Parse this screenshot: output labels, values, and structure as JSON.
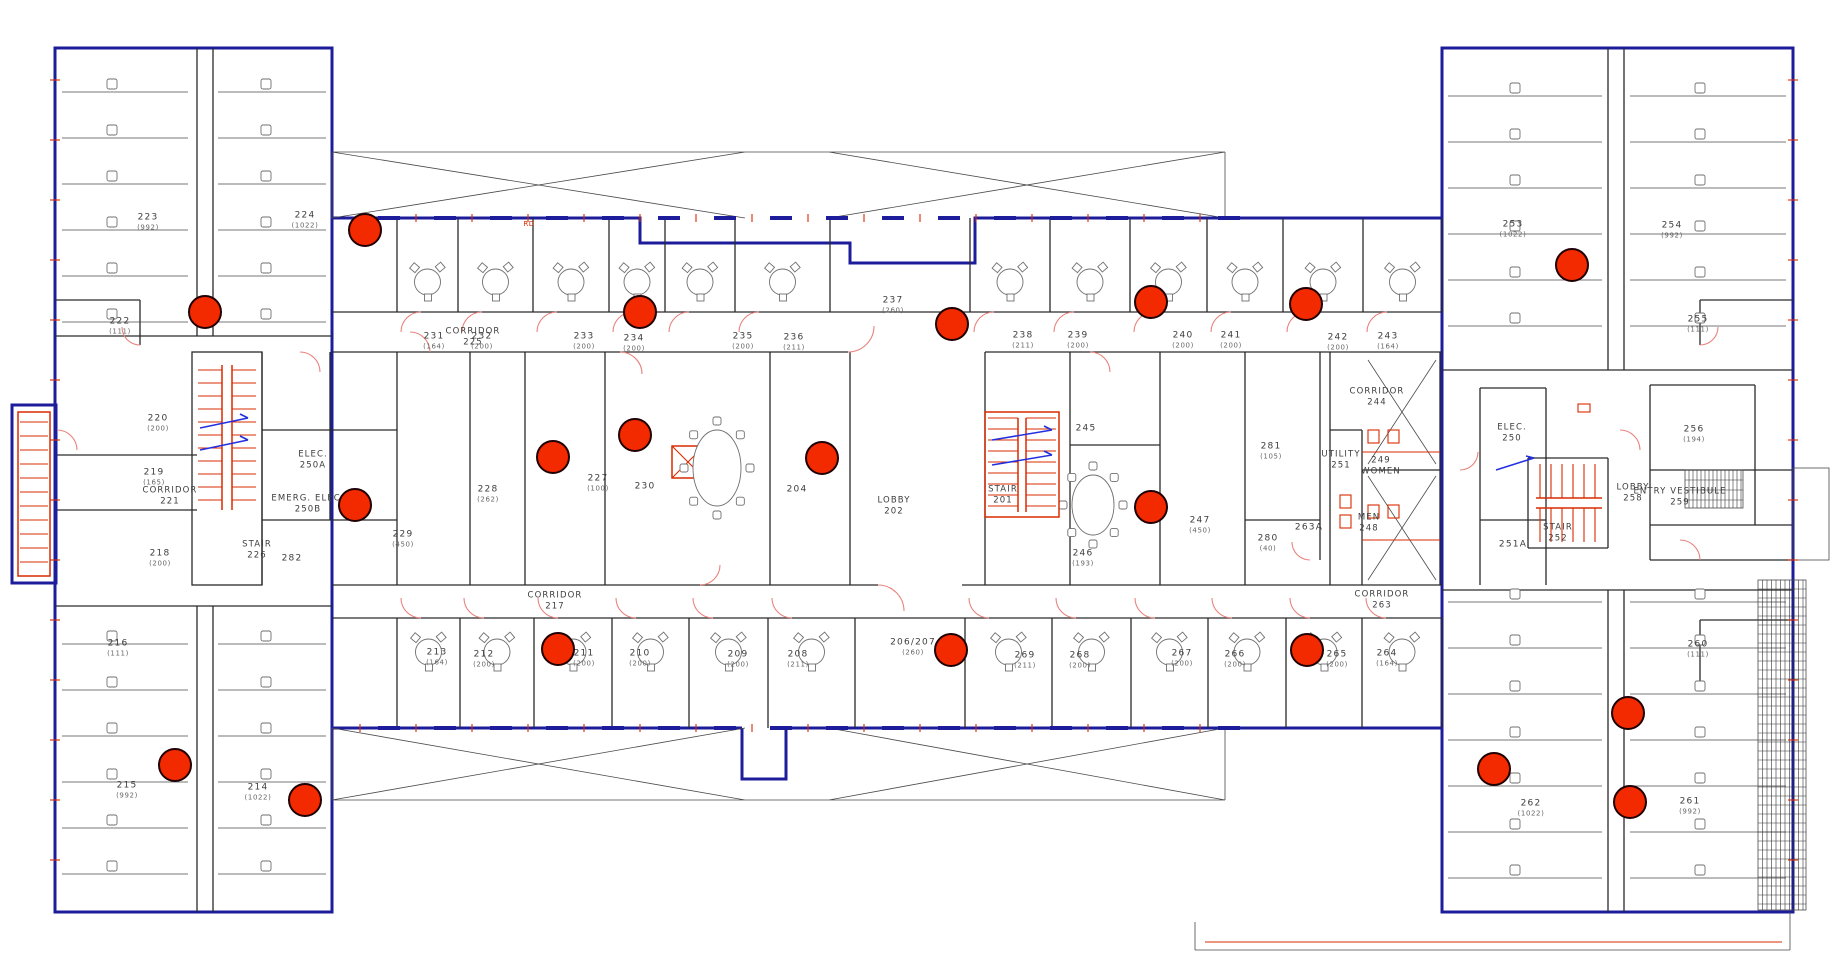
{
  "drawing": {
    "kind": "office floor plan",
    "style": {
      "marker_color": "#f32900",
      "exterior_wall_color": "#1d1d9c",
      "stair_color": "#d92b00",
      "door_swing_color": "#e8837d",
      "stair_arrow_color": "#2330e0",
      "label_color": "#3d3d3d"
    }
  },
  "rooms": [
    {
      "number": "223",
      "area": "(992)",
      "x": 148,
      "y": 222
    },
    {
      "number": "224",
      "area": "(1022)",
      "x": 305,
      "y": 220
    },
    {
      "number": "222",
      "area": "(111)",
      "x": 120,
      "y": 326
    },
    {
      "number": "220",
      "area": "(200)",
      "x": 158,
      "y": 423
    },
    {
      "number": "219",
      "area": "(165)",
      "x": 154,
      "y": 477
    },
    {
      "number": "218",
      "area": "(200)",
      "x": 160,
      "y": 558
    },
    {
      "number": "216",
      "area": "(111)",
      "x": 118,
      "y": 648
    },
    {
      "number": "215",
      "area": "(992)",
      "x": 127,
      "y": 790
    },
    {
      "number": "214",
      "area": "(1022)",
      "x": 258,
      "y": 792
    },
    {
      "number": "231",
      "area": "(164)",
      "x": 434,
      "y": 341
    },
    {
      "number": "232",
      "area": "(200)",
      "x": 482,
      "y": 341
    },
    {
      "number": "233",
      "area": "(200)",
      "x": 584,
      "y": 341
    },
    {
      "number": "234",
      "area": "(200)",
      "x": 634,
      "y": 343
    },
    {
      "number": "235",
      "area": "(200)",
      "x": 743,
      "y": 341
    },
    {
      "number": "236",
      "area": "(211)",
      "x": 794,
      "y": 342
    },
    {
      "number": "237",
      "area": "(260)",
      "x": 893,
      "y": 305
    },
    {
      "number": "238",
      "area": "(211)",
      "x": 1023,
      "y": 340
    },
    {
      "number": "239",
      "area": "(200)",
      "x": 1078,
      "y": 340
    },
    {
      "number": "240",
      "area": "(200)",
      "x": 1183,
      "y": 340
    },
    {
      "number": "241",
      "area": "(200)",
      "x": 1231,
      "y": 340
    },
    {
      "number": "242",
      "area": "(200)",
      "x": 1338,
      "y": 342
    },
    {
      "number": "243",
      "area": "(164)",
      "x": 1388,
      "y": 341
    },
    {
      "number": "253",
      "area": "(1022)",
      "x": 1513,
      "y": 229
    },
    {
      "number": "254",
      "area": "(992)",
      "x": 1672,
      "y": 230
    },
    {
      "number": "255",
      "area": "(111)",
      "x": 1698,
      "y": 324
    },
    {
      "number": "256",
      "area": "(194)",
      "x": 1694,
      "y": 434
    },
    {
      "number": "251A",
      "area": "",
      "x": 1513,
      "y": 545
    },
    {
      "number": "245",
      "area": "",
      "x": 1086,
      "y": 429
    },
    {
      "number": "246",
      "area": "(193)",
      "x": 1083,
      "y": 558
    },
    {
      "number": "247",
      "area": "(450)",
      "x": 1200,
      "y": 525
    },
    {
      "number": "281",
      "area": "(105)",
      "x": 1271,
      "y": 451
    },
    {
      "number": "280",
      "area": "(40)",
      "x": 1268,
      "y": 543
    },
    {
      "number": "263A",
      "area": "",
      "x": 1309,
      "y": 528
    },
    {
      "number": "282",
      "area": "",
      "x": 292,
      "y": 559
    },
    {
      "number": "229",
      "area": "(450)",
      "x": 403,
      "y": 539
    },
    {
      "number": "228",
      "area": "(262)",
      "x": 488,
      "y": 494
    },
    {
      "number": "227",
      "area": "(100)",
      "x": 598,
      "y": 483
    },
    {
      "number": "230",
      "area": "",
      "x": 645,
      "y": 487
    },
    {
      "number": "204",
      "area": "",
      "x": 797,
      "y": 490
    },
    {
      "number": "213",
      "area": "(164)",
      "x": 437,
      "y": 657
    },
    {
      "number": "212",
      "area": "(200)",
      "x": 484,
      "y": 659
    },
    {
      "number": "211",
      "area": "(200)",
      "x": 584,
      "y": 658
    },
    {
      "number": "210",
      "area": "(200)",
      "x": 640,
      "y": 658
    },
    {
      "number": "209",
      "area": "(200)",
      "x": 738,
      "y": 659
    },
    {
      "number": "208",
      "area": "(211)",
      "x": 798,
      "y": 659
    },
    {
      "number": "206/207",
      "area": "(260)",
      "x": 913,
      "y": 647
    },
    {
      "number": "269",
      "area": "(211)",
      "x": 1025,
      "y": 660
    },
    {
      "number": "268",
      "area": "(200)",
      "x": 1080,
      "y": 660
    },
    {
      "number": "267",
      "area": "(200)",
      "x": 1182,
      "y": 658
    },
    {
      "number": "266",
      "area": "(200)",
      "x": 1235,
      "y": 659
    },
    {
      "number": "265",
      "area": "(200)",
      "x": 1337,
      "y": 659
    },
    {
      "number": "264",
      "area": "(164)",
      "x": 1387,
      "y": 658
    },
    {
      "number": "260",
      "area": "(111)",
      "x": 1698,
      "y": 649
    },
    {
      "number": "262",
      "area": "(1022)",
      "x": 1531,
      "y": 808
    },
    {
      "number": "261",
      "area": "(992)",
      "x": 1690,
      "y": 806
    }
  ],
  "spaces": [
    {
      "line1": "CORRIDOR",
      "line2": "225",
      "x": 473,
      "y": 338
    },
    {
      "line1": "CORRIDOR",
      "line2": "217",
      "x": 555,
      "y": 602
    },
    {
      "line1": "CORRIDOR",
      "line2": "221",
      "x": 170,
      "y": 497
    },
    {
      "line1": "CORRIDOR",
      "line2": "244",
      "x": 1377,
      "y": 398
    },
    {
      "line1": "CORRIDOR",
      "line2": "263",
      "x": 1382,
      "y": 601
    },
    {
      "line1": "STAIR",
      "line2": "226",
      "x": 257,
      "y": 551
    },
    {
      "line1": "STAIR",
      "line2": "201",
      "x": 1003,
      "y": 496
    },
    {
      "line1": "STAIR",
      "line2": "252",
      "x": 1558,
      "y": 534
    },
    {
      "line1": "LOBBY",
      "line2": "202",
      "x": 894,
      "y": 507
    },
    {
      "line1": "LOBBY",
      "line2": "258",
      "x": 1633,
      "y": 494
    },
    {
      "line1": "ELEC.",
      "line2": "250A",
      "x": 313,
      "y": 461
    },
    {
      "line1": "EMERG. ELEC.",
      "line2": "250B",
      "x": 308,
      "y": 505
    },
    {
      "line1": "ELEC.",
      "line2": "250",
      "x": 1512,
      "y": 434
    },
    {
      "line1": "UTILITY",
      "line2": "251",
      "x": 1341,
      "y": 461
    },
    {
      "line1": "249",
      "line2": "WOMEN",
      "x": 1381,
      "y": 467
    },
    {
      "line1": "MEN",
      "line2": "248",
      "x": 1369,
      "y": 524
    },
    {
      "line1": "ENTRY VESTIBULE",
      "line2": "259",
      "x": 1680,
      "y": 498
    }
  ],
  "markers": [
    {
      "x": 205,
      "y": 312
    },
    {
      "x": 365,
      "y": 230
    },
    {
      "x": 640,
      "y": 312
    },
    {
      "x": 952,
      "y": 324
    },
    {
      "x": 1151,
      "y": 302
    },
    {
      "x": 1306,
      "y": 304
    },
    {
      "x": 1572,
      "y": 265
    },
    {
      "x": 355,
      "y": 505
    },
    {
      "x": 553,
      "y": 457
    },
    {
      "x": 635,
      "y": 435
    },
    {
      "x": 822,
      "y": 458
    },
    {
      "x": 1151,
      "y": 507
    },
    {
      "x": 558,
      "y": 649
    },
    {
      "x": 951,
      "y": 650
    },
    {
      "x": 1307,
      "y": 650
    },
    {
      "x": 175,
      "y": 765
    },
    {
      "x": 305,
      "y": 800
    },
    {
      "x": 1494,
      "y": 769
    },
    {
      "x": 1628,
      "y": 713
    },
    {
      "x": 1630,
      "y": 802
    }
  ],
  "annotations": [
    {
      "text": "RD",
      "x": 529,
      "y": 224
    }
  ]
}
